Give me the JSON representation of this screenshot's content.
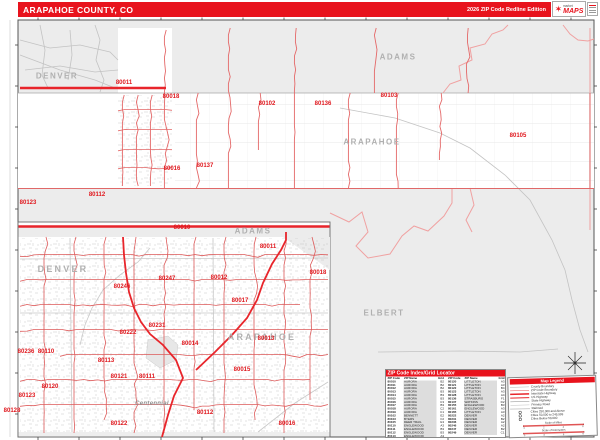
{
  "header": {
    "title": "ARAPAHOE COUNTY, CO",
    "edition": "2026 ZIP Code Redline Edition",
    "logo": {
      "top": "market",
      "main": "MAPS"
    }
  },
  "main_map": {
    "labels": [
      {
        "t": "DENVER",
        "x": 57,
        "y": 76,
        "k": "county"
      },
      {
        "t": "ADAMS",
        "x": 398,
        "y": 57,
        "k": "county"
      },
      {
        "t": "ARAPAHOE",
        "x": 372,
        "y": 142,
        "k": "county"
      },
      {
        "t": "ELBERT",
        "x": 384,
        "y": 313,
        "k": "county"
      },
      {
        "t": "80011",
        "x": 124,
        "y": 83,
        "k": "zip"
      },
      {
        "t": "80018",
        "x": 171,
        "y": 97,
        "k": "zip"
      },
      {
        "t": "80102",
        "x": 267,
        "y": 104,
        "k": "zip"
      },
      {
        "t": "80136",
        "x": 323,
        "y": 104,
        "k": "zip"
      },
      {
        "t": "80103",
        "x": 389,
        "y": 96,
        "k": "zip"
      },
      {
        "t": "80105",
        "x": 518,
        "y": 136,
        "k": "zip"
      },
      {
        "t": "80016",
        "x": 172,
        "y": 169,
        "k": "zip"
      },
      {
        "t": "80137",
        "x": 205,
        "y": 166,
        "k": "zip"
      },
      {
        "t": "80112",
        "x": 97,
        "y": 195,
        "k": "zip"
      },
      {
        "t": "80123",
        "x": 28,
        "y": 203,
        "k": "zip"
      }
    ]
  },
  "inset_map": {
    "labels": [
      {
        "t": "ADAMS",
        "x": 253,
        "y": 231,
        "k": "county"
      },
      {
        "t": "DENVER",
        "x": 63,
        "y": 269,
        "k": "countybig"
      },
      {
        "t": "ARAPAHOE",
        "x": 262,
        "y": 337,
        "k": "countybig"
      },
      {
        "t": "Centennial",
        "x": 152,
        "y": 404,
        "k": "city"
      },
      {
        "t": "80010",
        "x": 182,
        "y": 228,
        "k": "zip"
      },
      {
        "t": "80011",
        "x": 268,
        "y": 247,
        "k": "zip"
      },
      {
        "t": "80018",
        "x": 318,
        "y": 273,
        "k": "zip"
      },
      {
        "t": "80012",
        "x": 219,
        "y": 278,
        "k": "zip"
      },
      {
        "t": "80247",
        "x": 167,
        "y": 279,
        "k": "zip"
      },
      {
        "t": "80246",
        "x": 122,
        "y": 287,
        "k": "zip"
      },
      {
        "t": "80017",
        "x": 240,
        "y": 301,
        "k": "zip"
      },
      {
        "t": "80231",
        "x": 157,
        "y": 326,
        "k": "zip"
      },
      {
        "t": "80222",
        "x": 128,
        "y": 333,
        "k": "zip"
      },
      {
        "t": "80013",
        "x": 266,
        "y": 339,
        "k": "zip"
      },
      {
        "t": "80014",
        "x": 190,
        "y": 344,
        "k": "zip"
      },
      {
        "t": "80236",
        "x": 26,
        "y": 352,
        "k": "zip"
      },
      {
        "t": "80110",
        "x": 46,
        "y": 352,
        "k": "zip"
      },
      {
        "t": "80113",
        "x": 106,
        "y": 361,
        "k": "zip"
      },
      {
        "t": "80015",
        "x": 242,
        "y": 370,
        "k": "zip"
      },
      {
        "t": "80121",
        "x": 119,
        "y": 377,
        "k": "zip"
      },
      {
        "t": "80111",
        "x": 147,
        "y": 377,
        "k": "zip"
      },
      {
        "t": "80120",
        "x": 50,
        "y": 387,
        "k": "zip"
      },
      {
        "t": "80123",
        "x": 27,
        "y": 396,
        "k": "zip"
      },
      {
        "t": "80128",
        "x": 12,
        "y": 411,
        "k": "zip"
      },
      {
        "t": "80112",
        "x": 205,
        "y": 413,
        "k": "zip"
      },
      {
        "t": "80122",
        "x": 119,
        "y": 424,
        "k": "zip"
      },
      {
        "t": "80016",
        "x": 287,
        "y": 424,
        "k": "zip"
      }
    ]
  },
  "zip_index": {
    "title": "ZIP Code Index/Grid Locator",
    "columns": [
      "ZIP Code",
      "ZIP Name",
      "Grid"
    ],
    "left": [
      [
        "80010",
        "AURORA",
        "B2"
      ],
      [
        "80011",
        "AURORA",
        "B2"
      ],
      [
        "80012",
        "AURORA",
        "B2"
      ],
      [
        "80013",
        "AURORA",
        "B3"
      ],
      [
        "80014",
        "AURORA",
        "B3"
      ],
      [
        "80015",
        "AURORA",
        "B3"
      ],
      [
        "80016",
        "AURORA",
        "C3"
      ],
      [
        "80017",
        "AURORA",
        "B3"
      ],
      [
        "80018",
        "AURORA",
        "C2"
      ],
      [
        "80019",
        "AURORA",
        "C1"
      ],
      [
        "80102",
        "BENNETT",
        "E2"
      ],
      [
        "80103",
        "BYERS",
        "F2"
      ],
      [
        "80105",
        "DEER TRAIL",
        "G3"
      ],
      [
        "80110",
        "ENGLEWOOD",
        "A3"
      ],
      [
        "80111",
        "ENGLEWOOD",
        "B3"
      ],
      [
        "80112",
        "ENGLEWOOD",
        "B3"
      ],
      [
        "80113",
        "ENGLEWOOD",
        "A3"
      ]
    ],
    "right": [
      [
        "80120",
        "LITTLETON",
        "A3"
      ],
      [
        "80121",
        "LITTLETON",
        "A3"
      ],
      [
        "80122",
        "LITTLETON",
        "B4"
      ],
      [
        "80123",
        "LITTLETON",
        "A3"
      ],
      [
        "80128",
        "LITTLETON",
        "A4"
      ],
      [
        "80136",
        "STRASBURG",
        "F1"
      ],
      [
        "80137",
        "WATKINS",
        "D2"
      ],
      [
        "80155",
        "ENGLEWOOD",
        "B3"
      ],
      [
        "80161",
        "ENGLEWOOD",
        "A3"
      ],
      [
        "80165",
        "LITTLETON",
        "A3"
      ],
      [
        "80222",
        "DENVER",
        "A2"
      ],
      [
        "80231",
        "DENVER",
        "B2"
      ],
      [
        "80236",
        "DENVER",
        "A2"
      ],
      [
        "80246",
        "DENVER",
        "A2"
      ],
      [
        "80247",
        "DENVER",
        "B2"
      ],
      [
        "80249",
        "DENVER",
        "C1"
      ]
    ]
  },
  "legend": {
    "title": "Map Legend",
    "line_items": [
      {
        "label": "County Boundary",
        "style": "county"
      },
      {
        "label": "ZIP Code Boundary",
        "style": "zip"
      },
      {
        "label": "Interstate Highway",
        "style": "interstate"
      },
      {
        "label": "US Highway",
        "style": "ushwy"
      },
      {
        "label": "State Highway",
        "style": "statehwy"
      },
      {
        "label": "Primary Road",
        "style": "road"
      },
      {
        "label": "Railroad",
        "style": "rail"
      }
    ],
    "city_items": [
      "Cities 250,000 and Above",
      "Cities 50,000 to 249,999",
      "Cities Below 50,000"
    ],
    "scalebars": [
      {
        "label": "Scale of Miles",
        "ticks": [
          "0",
          "2",
          "4",
          "6"
        ]
      },
      {
        "label": "Scale of Kilometers",
        "ticks": [
          "0",
          "3",
          "6",
          "9"
        ]
      }
    ]
  },
  "colors": {
    "header_red": "#e8131d",
    "zip_red": "#e0181e",
    "boundary_red": "#e36a6a",
    "county_gray": "#b0b0b0",
    "bg_gray": "#ececec"
  }
}
